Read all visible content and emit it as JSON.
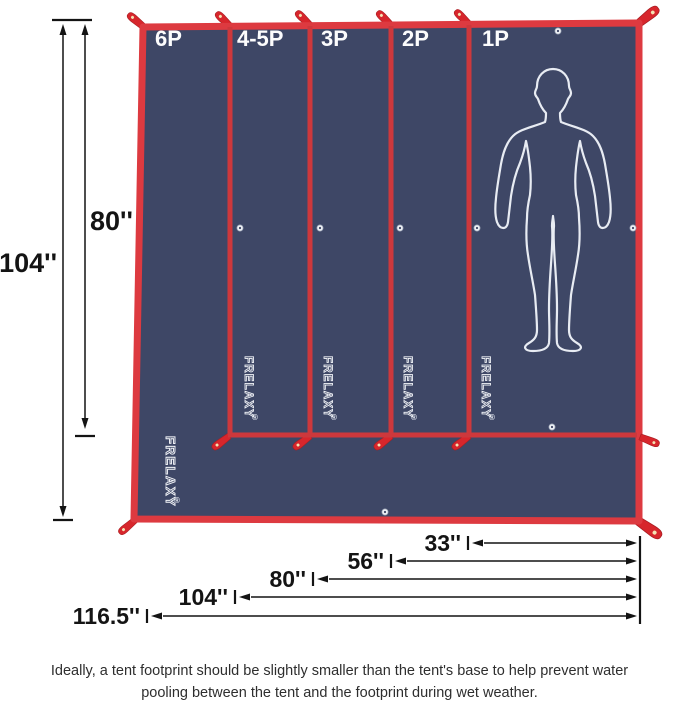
{
  "panel_labels": [
    "6P",
    "4-5P",
    "3P",
    "2P",
    "1P"
  ],
  "brand": {
    "name": "FRELAXY",
    "registered_mark": "®"
  },
  "dimensions": {
    "height_labels": [
      "104''",
      "80''"
    ],
    "width_labels": [
      "33''",
      "56''",
      "80''",
      "104''",
      "116.5''"
    ]
  },
  "caption": {
    "line1": "Ideally, a tent footprint should be slightly smaller than the tent's base to help prevent water",
    "line2": "pooling between the tent and the footprint during wet weather."
  },
  "colors": {
    "tarp_navy": "#3e4766",
    "edge_red": "#dd3a40",
    "divider_red": "#cd383c",
    "strap_red": "#d7262c",
    "silhouette_white": "#e8ecf3",
    "dimension_text": "#141414",
    "caption_text": "#2e2e2e",
    "background": "#ffffff"
  }
}
